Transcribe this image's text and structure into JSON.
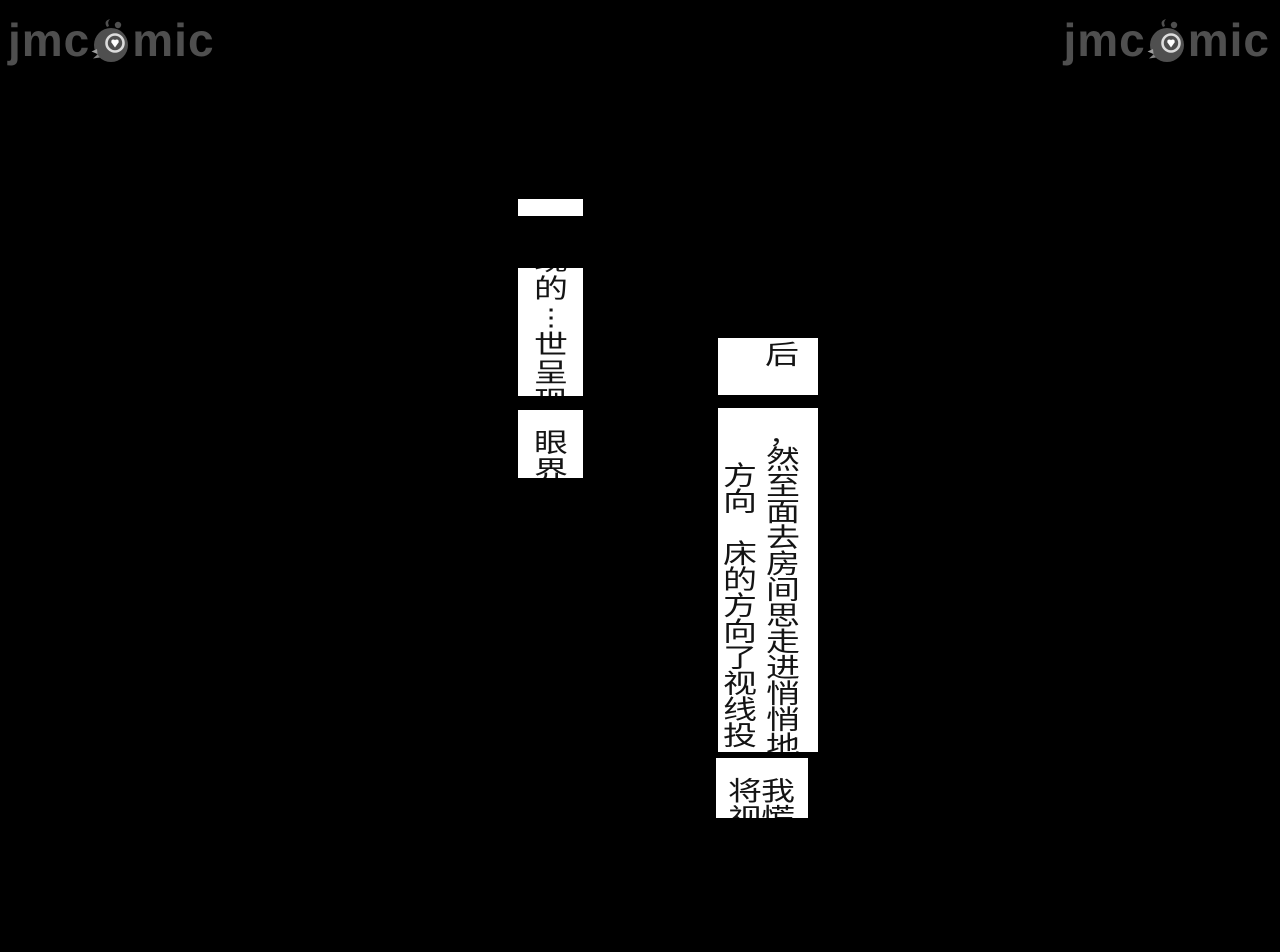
{
  "page": {
    "background_color": "#000000",
    "description": "comic reader page, artwork area black with only white speech-bubble fragments visible"
  },
  "watermark": {
    "prefix": "jmc",
    "suffix": "mic",
    "full_name": "jmcomic",
    "color": "#4f4f4f",
    "mascot_icon": "bird-mascot-icon"
  },
  "speech_bubbles": {
    "left_top_strip": {
      "text": ""
    },
    "left_main": {
      "column": [
        "现",
        "的",
        "⋮",
        "世",
        "呈",
        "现"
      ]
    },
    "left_lower": {
      "column": [
        "眼",
        "界"
      ]
    },
    "right_top": {
      "column": [
        "后"
      ]
    },
    "right_main": {
      "column_right": [
        "一",
        "，",
        "然",
        "至",
        "面",
        "去",
        "房",
        "间",
        "思",
        "走",
        "进",
        "悄",
        "悄",
        "地"
      ],
      "column_left": [
        "",
        "",
        "方",
        "向",
        "",
        "床",
        "的",
        "方",
        "向",
        "了",
        "视",
        "线",
        "投"
      ]
    },
    "right_bottom": {
      "column_right": [
        "我",
        "慌"
      ],
      "column_left": [
        "将",
        "视"
      ]
    }
  }
}
